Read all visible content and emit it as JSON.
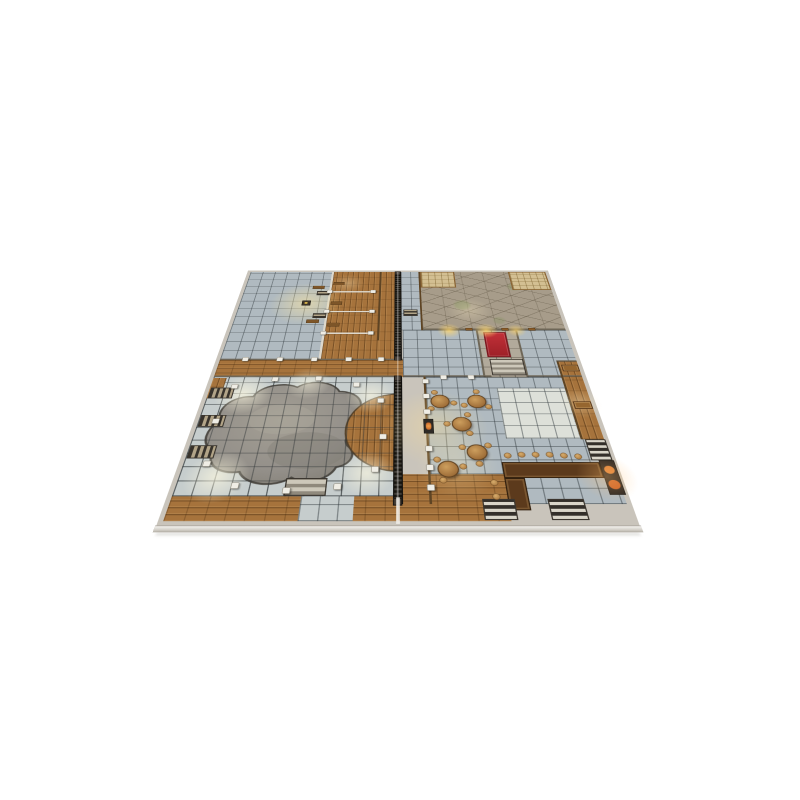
{
  "image": {
    "kind": "product photo on plain white background",
    "subject": "two-panel tabletop RPG battle-map tiles (inn / tavern and bath-house floor plan) shown flat in perspective",
    "description": "Square grid battle map viewed at an angle: west half holds a large blue-grey tiled hall, wooden changing stalls and a huge sunken grey pool ringed by white pillars and wooden stairs; a dark spiked palisade runs along the centre seam between the two map tiles; east half holds a cracked flagstone courtyard with thatched awnings, a red-carpet entry hall with steps, a tavern common room with round tables and stools, writing desks, an L-shaped bar with stools, a fireplace and several staircases.",
    "background_color": "#ffffff"
  },
  "map": {
    "halves": [
      "west tile: bath house with pool",
      "east tile: courtyard and tavern"
    ],
    "rooms": [
      "tiled bath antechamber with altar and benches",
      "wooden changing stalls",
      "central wooden corridor with spiked palisade",
      "great pool hall with irregular sunken pool and pillar ring",
      "flagstone courtyard with thatched awnings",
      "red carpet entry hall with steps and lantern-lit doors",
      "side rooms with blue-grey tile floors",
      "tavern common room with round tables",
      "writing-desk niches on east wall",
      "bar corner with L-shaped counter, stools and fireplace",
      "wooden south walkway with staircases"
    ],
    "palette": {
      "bg": "#ffffff",
      "tiles": "#b0bac0",
      "wood": "#a6733c",
      "flag": "#a79c8a",
      "tan": "#d3bf92",
      "pool": "#94908a",
      "carpet": "#9e2128",
      "bar": "#5c3a1c",
      "palisade": "#1c1916",
      "edge": "#cdc9c1"
    },
    "grid_cell_px": 30,
    "features": [
      {
        "t": "glow",
        "x": 160,
        "y": 142,
        "r": 85,
        "c": "rgba(255,232,160,0.55)"
      },
      {
        "t": "glow",
        "x": 250,
        "y": 60,
        "r": 40,
        "c": "rgba(255,240,200,0.30)"
      },
      {
        "t": "glow",
        "x": 75,
        "y": 445,
        "r": 55,
        "c": "rgba(255,250,225,0.65)"
      },
      {
        "t": "glow",
        "x": 318,
        "y": 450,
        "r": 48,
        "c": "rgba(255,250,225,0.60)"
      },
      {
        "t": "glow",
        "x": 70,
        "y": 645,
        "r": 55,
        "c": "rgba(255,250,225,0.65)"
      },
      {
        "t": "glow",
        "x": 318,
        "y": 638,
        "r": 48,
        "c": "rgba(255,250,225,0.60)"
      },
      {
        "t": "glow",
        "x": 195,
        "y": 415,
        "r": 45,
        "c": "rgba(255,250,225,0.50)"
      },
      {
        "t": "glow",
        "x": 530,
        "y": 170,
        "r": 50,
        "c": "rgba(255,240,200,0.30)"
      },
      {
        "t": "glow",
        "x": 480,
        "y": 246,
        "r": 26,
        "c": "rgba(255,214,110,0.80)"
      },
      {
        "t": "glow",
        "x": 560,
        "y": 246,
        "r": 26,
        "c": "rgba(255,214,110,0.80)"
      },
      {
        "t": "glow",
        "x": 625,
        "y": 246,
        "r": 22,
        "c": "rgba(255,214,110,0.70)"
      },
      {
        "t": "glow",
        "x": 438,
        "y": 530,
        "r": 95,
        "c": "rgba(255,224,150,0.40)"
      },
      {
        "t": "glow",
        "x": 470,
        "y": 620,
        "r": 70,
        "c": "rgba(255,235,180,0.30)"
      },
      {
        "t": "glow",
        "x": 712,
        "y": 470,
        "r": 40,
        "c": "rgba(255,240,200,0.35)"
      },
      {
        "t": "glow",
        "x": 715,
        "y": 645,
        "r": 50,
        "c": "rgba(255,190,110,0.35)"
      },
      {
        "t": "stair",
        "v": "v",
        "x": 10,
        "y": 428,
        "w": 46,
        "h": 30
      },
      {
        "t": "stair",
        "v": "v",
        "x": 10,
        "y": 502,
        "w": 46,
        "h": 30
      },
      {
        "t": "stair",
        "v": "v",
        "x": 10,
        "y": 576,
        "w": 46,
        "h": 30
      },
      {
        "t": "stair",
        "v": "hl",
        "x": 186,
        "y": 648,
        "w": 68,
        "h": 36
      },
      {
        "t": "stair",
        "v": "h",
        "x": 382,
        "y": 168,
        "w": 32,
        "h": 24
      },
      {
        "t": "stair",
        "v": "hl",
        "x": 556,
        "y": 342,
        "w": 68,
        "h": 50
      },
      {
        "t": "stair",
        "v": "h",
        "x": 180,
        "y": 92,
        "w": 30,
        "h": 18
      },
      {
        "t": "stair",
        "v": "h",
        "x": 180,
        "y": 182,
        "w": 30,
        "h": 18
      },
      {
        "t": "stair",
        "v": "hd",
        "x": 698,
        "y": 562,
        "w": 36,
        "h": 48
      },
      {
        "t": "stair",
        "v": "hd",
        "x": 608,
        "y": 690,
        "w": 58,
        "h": 40
      },
      {
        "t": "stair",
        "v": "hd",
        "x": 504,
        "y": 690,
        "w": 52,
        "h": 40
      },
      {
        "t": "bench",
        "x": 216,
        "y": 54,
        "w": 26,
        "h": 13
      },
      {
        "t": "bench",
        "x": 216,
        "y": 136,
        "w": 26,
        "h": 13
      },
      {
        "t": "bench",
        "x": 216,
        "y": 218,
        "w": 26,
        "h": 13
      },
      {
        "t": "bench",
        "x": 168,
        "y": 70,
        "w": 28,
        "h": 13
      },
      {
        "t": "bench",
        "x": 168,
        "y": 206,
        "w": 28,
        "h": 13
      },
      {
        "t": "desk",
        "x": 698,
        "y": 360,
        "w": 34,
        "h": 20
      },
      {
        "t": "desk",
        "x": 698,
        "y": 466,
        "w": 34,
        "h": 20
      },
      {
        "t": "door",
        "x": 516,
        "y": 237,
        "w": 15,
        "h": 9
      },
      {
        "t": "door",
        "x": 594,
        "y": 237,
        "w": 15,
        "h": 9
      },
      {
        "t": "door",
        "x": 652,
        "y": 237,
        "w": 15,
        "h": 9
      },
      {
        "t": "altar",
        "x": 150,
        "y": 132,
        "w": 20,
        "h": 20
      },
      {
        "t": "hearth",
        "x": 416,
        "y": 512,
        "w": 18,
        "h": 36
      },
      {
        "t": "table",
        "x": 449,
        "y": 466
      },
      {
        "t": "table",
        "x": 518,
        "y": 466
      },
      {
        "t": "table",
        "x": 485,
        "y": 525
      },
      {
        "t": "table",
        "x": 506,
        "y": 592
      },
      {
        "t": "table",
        "x": 454,
        "y": 629
      },
      {
        "t": "stool",
        "x": 558,
        "y": 600
      },
      {
        "t": "stool",
        "x": 582,
        "y": 598
      },
      {
        "t": "stool",
        "x": 606,
        "y": 598
      },
      {
        "t": "stool",
        "x": 630,
        "y": 598
      },
      {
        "t": "stool",
        "x": 654,
        "y": 600
      },
      {
        "t": "stool",
        "x": 678,
        "y": 602
      },
      {
        "t": "stool",
        "x": 528,
        "y": 658
      },
      {
        "t": "stool",
        "x": 528,
        "y": 686
      },
      {
        "t": "pillar",
        "x": 55,
        "y": 425
      },
      {
        "t": "pillar",
        "x": 130,
        "y": 404
      },
      {
        "t": "pillar",
        "x": 215,
        "y": 402
      },
      {
        "t": "pillar",
        "x": 290,
        "y": 420
      },
      {
        "t": "pillar",
        "x": 338,
        "y": 464
      },
      {
        "t": "pillar",
        "x": 344,
        "y": 556
      },
      {
        "t": "pillar",
        "x": 332,
        "y": 630
      },
      {
        "t": "pillar",
        "x": 272,
        "y": 666
      },
      {
        "t": "pillar",
        "x": 190,
        "y": 674
      },
      {
        "t": "pillar",
        "x": 105,
        "y": 664
      },
      {
        "t": "pillar",
        "x": 48,
        "y": 618
      },
      {
        "t": "pillar",
        "x": 40,
        "y": 518
      },
      {
        "t": "pillar",
        "x": 424,
        "y": 410
      },
      {
        "t": "pillar",
        "x": 424,
        "y": 452
      },
      {
        "t": "pillar",
        "x": 424,
        "y": 494
      },
      {
        "t": "pillar",
        "x": 424,
        "y": 584
      },
      {
        "t": "pillar",
        "x": 424,
        "y": 626
      },
      {
        "t": "pillar",
        "x": 424,
        "y": 668
      },
      {
        "t": "pillar",
        "x": 460,
        "y": 398
      },
      {
        "t": "pillar",
        "x": 514,
        "y": 398
      },
      {
        "t": "pillar",
        "x": 60,
        "y": 343
      },
      {
        "t": "pillar",
        "x": 130,
        "y": 343
      },
      {
        "t": "pillar",
        "x": 200,
        "y": 343
      },
      {
        "t": "pillar",
        "x": 270,
        "y": 343
      },
      {
        "t": "pillar",
        "x": 336,
        "y": 343
      },
      {
        "t": "pillar",
        "x": 210,
        "y": 95
      },
      {
        "t": "pillar",
        "x": 312,
        "y": 95
      },
      {
        "t": "pillar",
        "x": 210,
        "y": 175
      },
      {
        "t": "pillar",
        "x": 312,
        "y": 175
      },
      {
        "t": "pillar",
        "x": 210,
        "y": 255
      },
      {
        "t": "pillar",
        "x": 312,
        "y": 255
      }
    ]
  }
}
